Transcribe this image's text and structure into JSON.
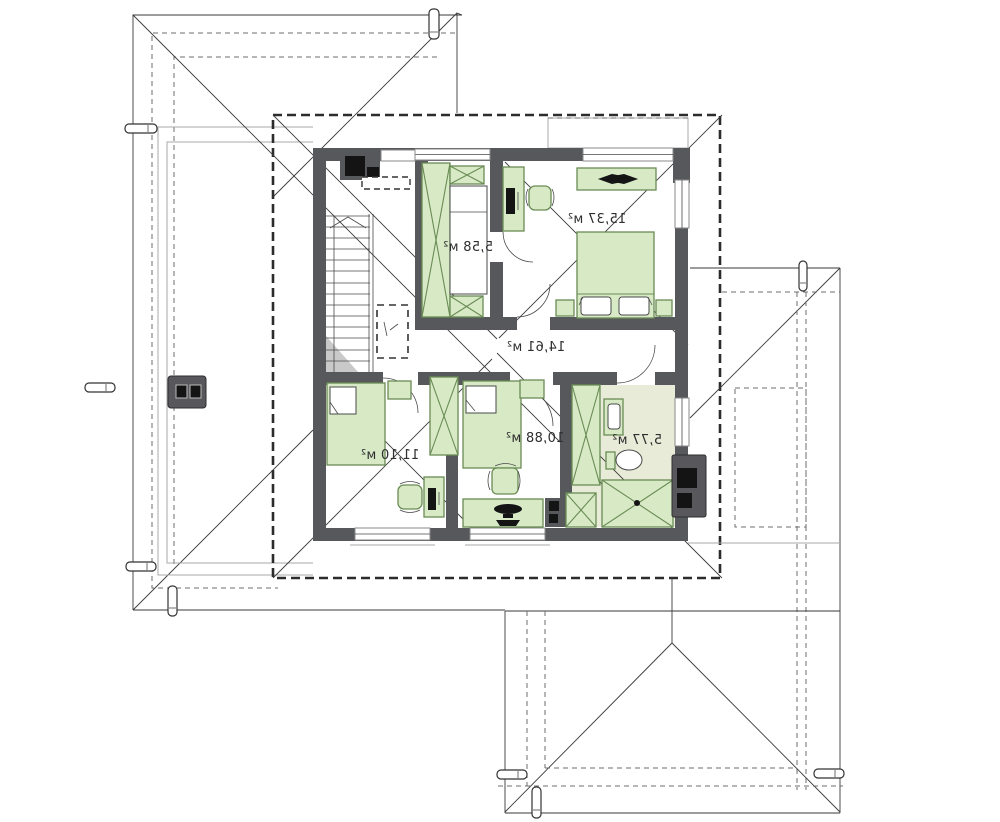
{
  "drawing": {
    "kind": "house upper-floor plan with roof outline",
    "area_unit": "м²",
    "labels_mirrored": true
  },
  "colors": {
    "wall": "#57585c",
    "furniture_fill": "#d8e9c6",
    "furniture_stroke": "#6a8c55",
    "bath_floor": "#e9ebd9",
    "line": "#3a3a3a",
    "accent_black": "#141414",
    "background": "#ffffff"
  },
  "rooms": [
    {
      "id": "bedroom-top-right",
      "area_label": "15,37 м²"
    },
    {
      "id": "closet-top-left",
      "area_label": "5,58 м²"
    },
    {
      "id": "hall-center",
      "area_label": "14,61 м²"
    },
    {
      "id": "bedroom-bottom-left",
      "area_label": "11,10 м²"
    },
    {
      "id": "bedroom-bottom-center",
      "area_label": "10,88 м²"
    },
    {
      "id": "bathroom",
      "area_label": "5,77 м²"
    }
  ],
  "stairs": {
    "visible_steps": 14
  }
}
